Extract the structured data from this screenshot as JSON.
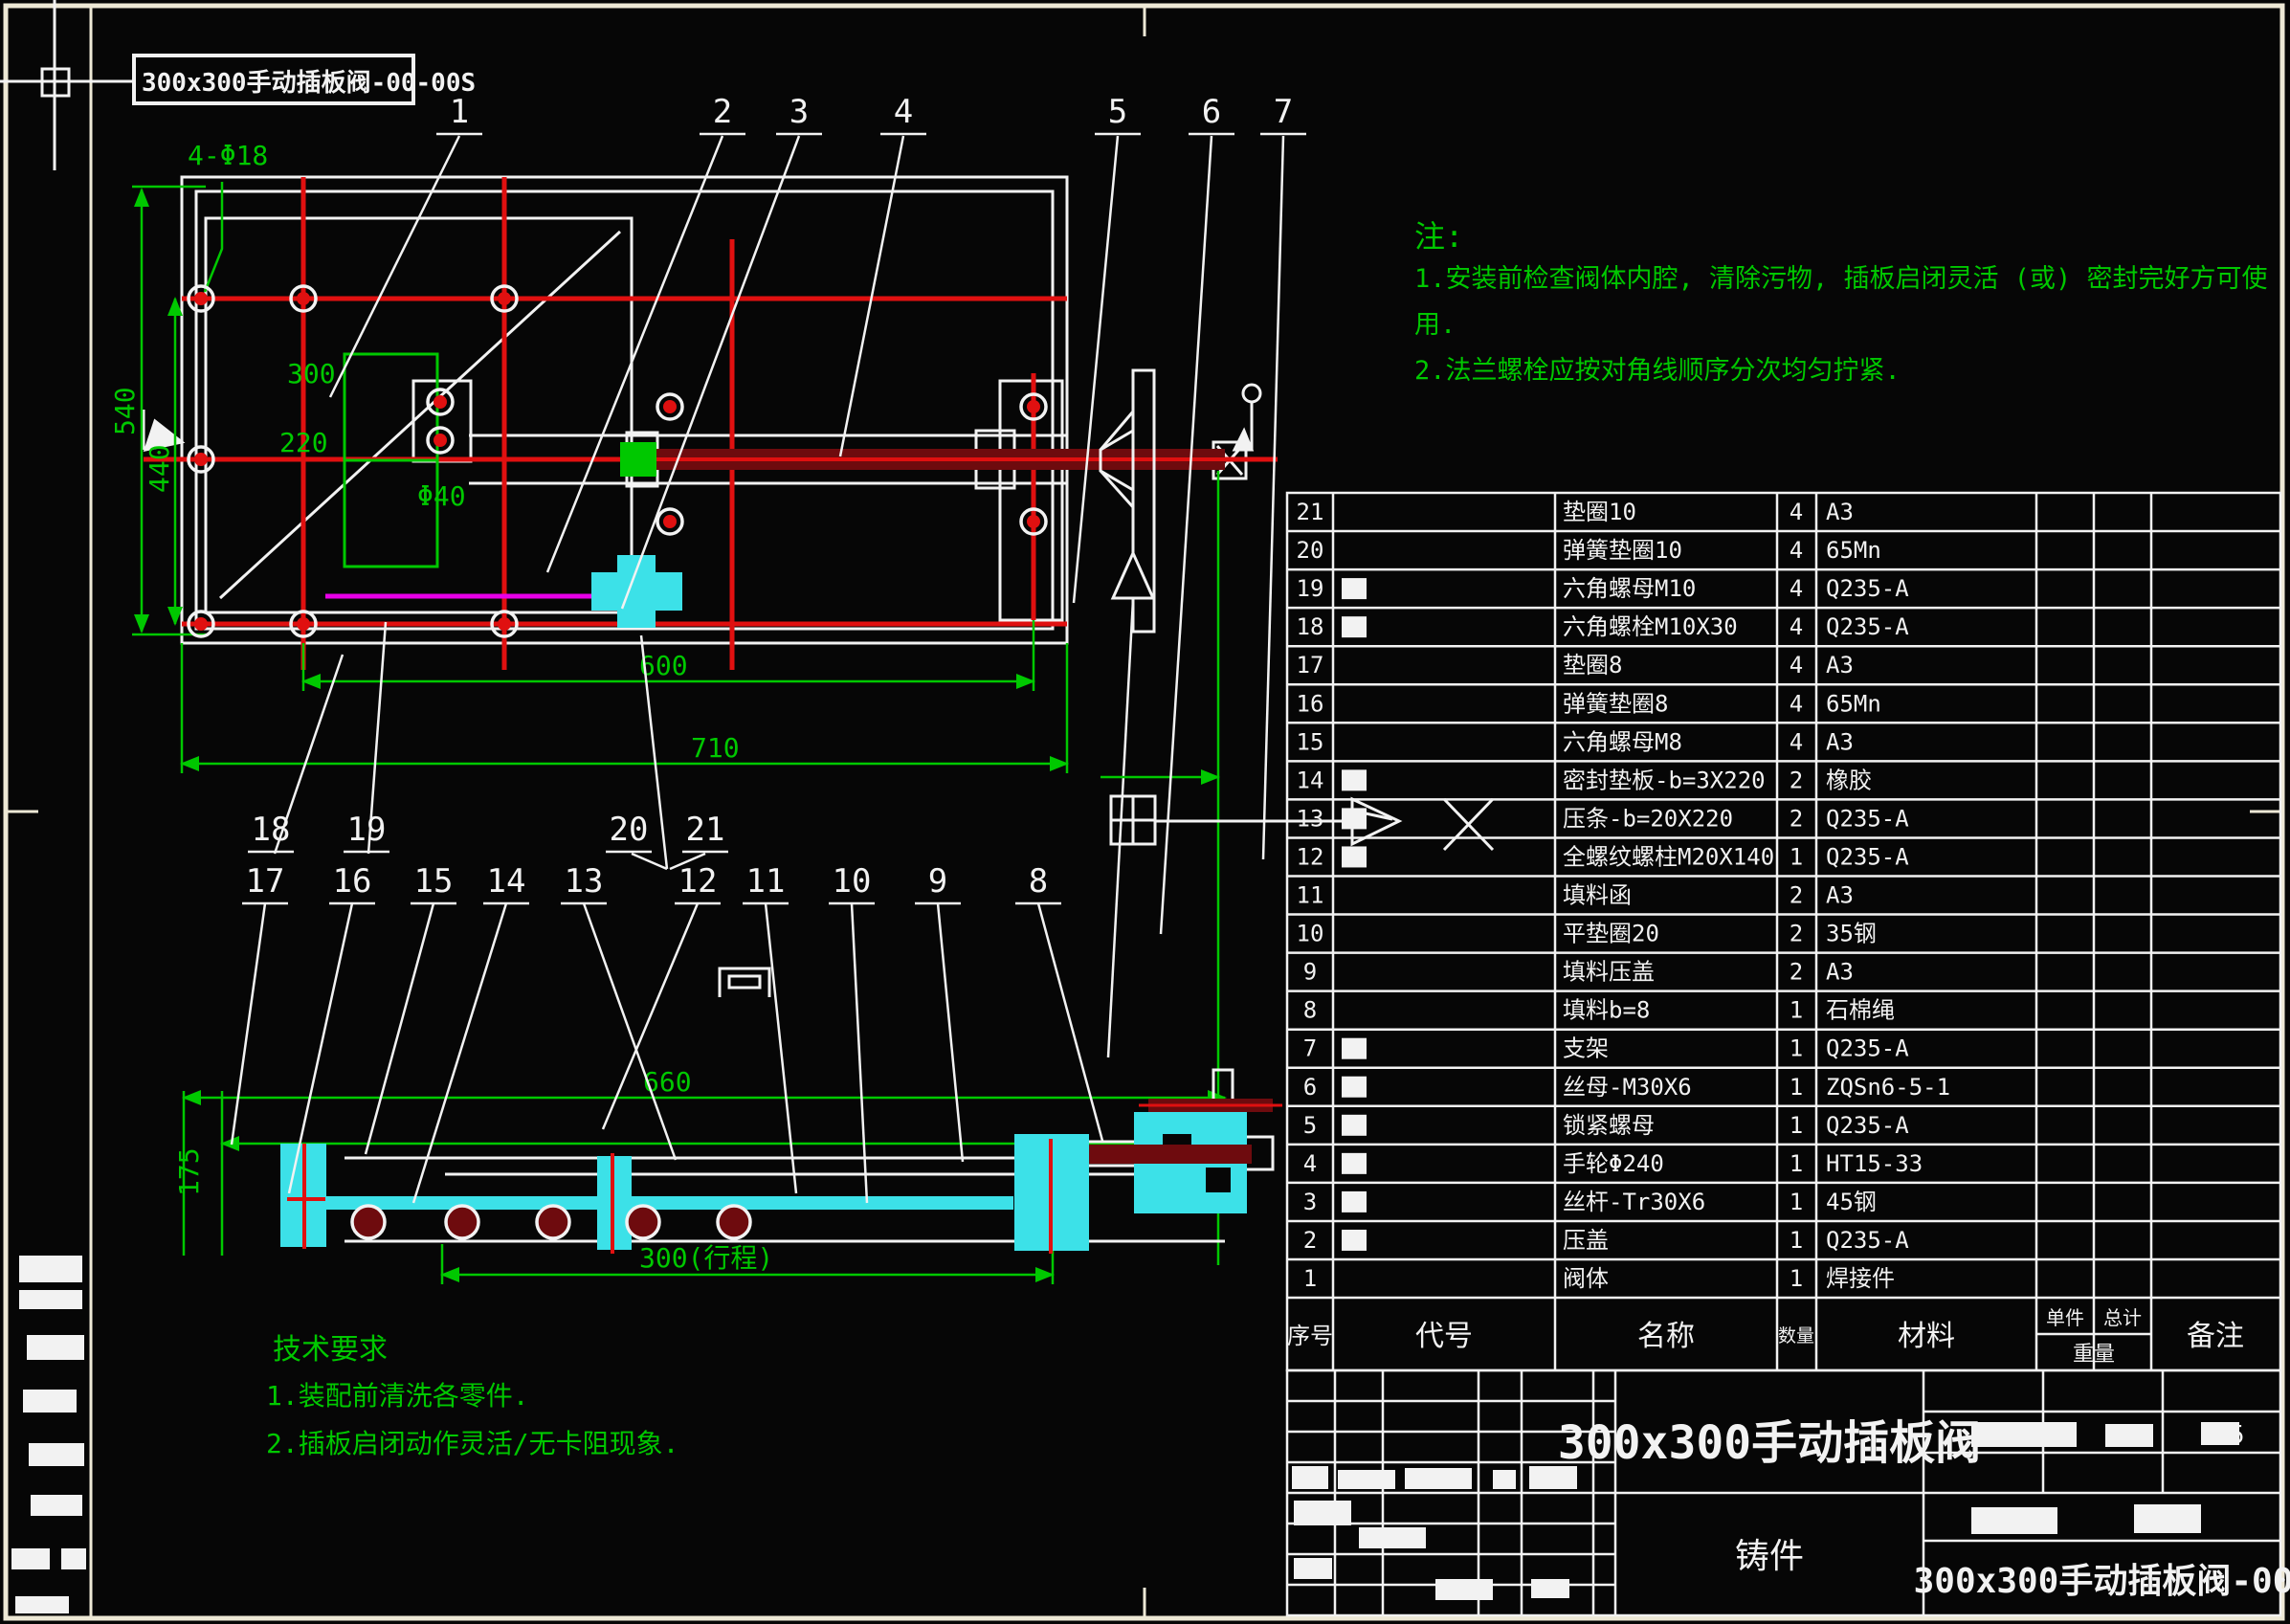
{
  "frame": {
    "label": "300x300手动插板阀-00-00S"
  },
  "notes_right": {
    "title": "注:",
    "lines": [
      "1.安装前检查阀体内腔, 清除污物, 插板启闭灵活 (或) 密封完好方可使",
      "用.",
      "2.法兰螺栓应按对角线顺序分次均匀拧紧."
    ]
  },
  "tech_notes": {
    "title": "技术要求",
    "lines": [
      "1.装配前清洗各零件.",
      "2.插板启闭动作灵活/无卡阻现象."
    ]
  },
  "dims": {
    "left_outer": "540",
    "left_inner": "440",
    "bolt_note": "4-Φ18",
    "inner_w": "300",
    "inner_h": "220",
    "gland": "Φ40",
    "bottom_upper": "600",
    "bottom_lower": "710",
    "sec_top": "660",
    "sec_left": "175",
    "sec_stroke": "300(行程)"
  },
  "balloons": {
    "top": [
      "1",
      "2",
      "3",
      "4",
      "5",
      "6",
      "7"
    ],
    "mid": [
      "18",
      "19",
      "20",
      "21"
    ],
    "low": [
      "17",
      "16",
      "15",
      "14",
      "13",
      "12",
      "11",
      "10",
      "9",
      "8"
    ]
  },
  "bom": {
    "headers": {
      "no": "序号",
      "code": "代号",
      "name": "名称",
      "qty": "数量",
      "mat": "材料",
      "unit": "单件",
      "total": "总计",
      "weight": "重量",
      "remark": "备注"
    },
    "rows": [
      {
        "no": "21",
        "code": "",
        "name": "垫圈10",
        "qty": "4",
        "mat": "A3",
        "blob": false
      },
      {
        "no": "20",
        "code": "",
        "name": "弹簧垫圈10",
        "qty": "4",
        "mat": "65Mn",
        "blob": false
      },
      {
        "no": "19",
        "code": "",
        "name": "六角螺母M10",
        "qty": "4",
        "mat": "Q235-A",
        "blob": true
      },
      {
        "no": "18",
        "code": "",
        "name": "六角螺栓M10X30",
        "qty": "4",
        "mat": "Q235-A",
        "blob": true
      },
      {
        "no": "17",
        "code": "",
        "name": "垫圈8",
        "qty": "4",
        "mat": "A3",
        "blob": false
      },
      {
        "no": "16",
        "code": "",
        "name": "弹簧垫圈8",
        "qty": "4",
        "mat": "65Mn",
        "blob": false
      },
      {
        "no": "15",
        "code": "",
        "name": "六角螺母M8",
        "qty": "4",
        "mat": "A3",
        "blob": false
      },
      {
        "no": "14",
        "code": "",
        "name": "密封垫板-b=3X220",
        "qty": "2",
        "mat": "橡胶",
        "blob": true
      },
      {
        "no": "13",
        "code": "",
        "name": "压条-b=20X220",
        "qty": "2",
        "mat": "Q235-A",
        "blob": true
      },
      {
        "no": "12",
        "code": "",
        "name": "全螺纹螺柱M20X140",
        "qty": "1",
        "mat": "Q235-A",
        "blob": true
      },
      {
        "no": "11",
        "code": "",
        "name": "填料函",
        "qty": "2",
        "mat": "A3",
        "blob": false
      },
      {
        "no": "10",
        "code": "",
        "name": "平垫圈20",
        "qty": "2",
        "mat": "35钢",
        "blob": false
      },
      {
        "no": "9",
        "code": "",
        "name": "填料压盖",
        "qty": "2",
        "mat": "A3",
        "blob": false
      },
      {
        "no": "8",
        "code": "",
        "name": "填料b=8",
        "qty": "1",
        "mat": "石棉绳",
        "blob": false
      },
      {
        "no": "7",
        "code": "",
        "name": "支架",
        "qty": "1",
        "mat": "Q235-A",
        "blob": true
      },
      {
        "no": "6",
        "code": "",
        "name": "丝母-M30X6",
        "qty": "1",
        "mat": "ZQSn6-5-1",
        "blob": true
      },
      {
        "no": "5",
        "code": "",
        "name": "锁紧螺母",
        "qty": "1",
        "mat": "Q235-A",
        "blob": true
      },
      {
        "no": "4",
        "code": "",
        "name": "手轮Φ240",
        "qty": "1",
        "mat": "HT15-33",
        "blob": true
      },
      {
        "no": "3",
        "code": "",
        "name": "丝杆-Tr30X6",
        "qty": "1",
        "mat": "45钢",
        "blob": true
      },
      {
        "no": "2",
        "code": "",
        "name": "压盖",
        "qty": "1",
        "mat": "Q235-A",
        "blob": true
      },
      {
        "no": "1",
        "code": "",
        "name": "阀体",
        "qty": "1",
        "mat": "焊接件",
        "blob": false
      }
    ]
  },
  "title_block": {
    "title": "300x300手动插板阀",
    "material_cell": "铸件",
    "drawing_no": "300x300手动插板阀-00",
    "scale": "1:5"
  },
  "colors": {
    "green": "#00C800",
    "red": "#E01010",
    "dark_red": "#6E0B0E",
    "magenta": "#E800E8",
    "cyan": "#3CE1E8",
    "white": "#F2F2F2",
    "frame": "#EDE8D5",
    "background": "#060606"
  }
}
